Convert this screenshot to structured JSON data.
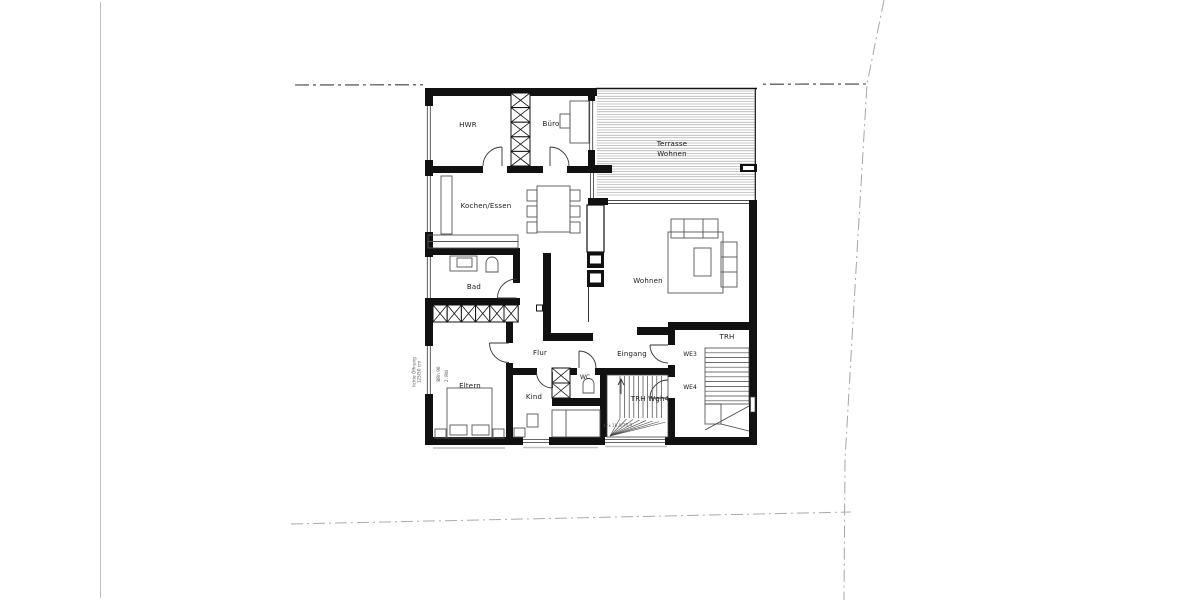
{
  "plan": {
    "labels": {
      "hwr": "HWR",
      "buero": "Büro",
      "terrasse_line1": "Terrasse",
      "terrasse_line2": "Wohnen",
      "kochen_essen": "Kochen/Essen",
      "wohnen": "Wohnen",
      "bad": "Bad",
      "flur": "Flur",
      "eingang": "Eingang",
      "we3": "WE3",
      "we4": "WE4",
      "trh": "TRH",
      "trh_wgh4": "TRH Wgh4",
      "eltern": "Eltern",
      "kind": "Kind",
      "wc": "WC"
    },
    "annotations": {
      "window_note_1": "lichte Öffnung",
      "window_note_2": "125/50 cm",
      "parapet_note": "BRh 90",
      "escape_note": "2. RW",
      "stair_note": "17x 18,0/25,0"
    },
    "colors": {
      "wall": "#111111",
      "line": "#3d3d3d",
      "hatch": "#949494",
      "boundary": "#a6a6a6",
      "boundary_dark": "#3c3c3c",
      "sill": "#c2c2c2"
    }
  }
}
